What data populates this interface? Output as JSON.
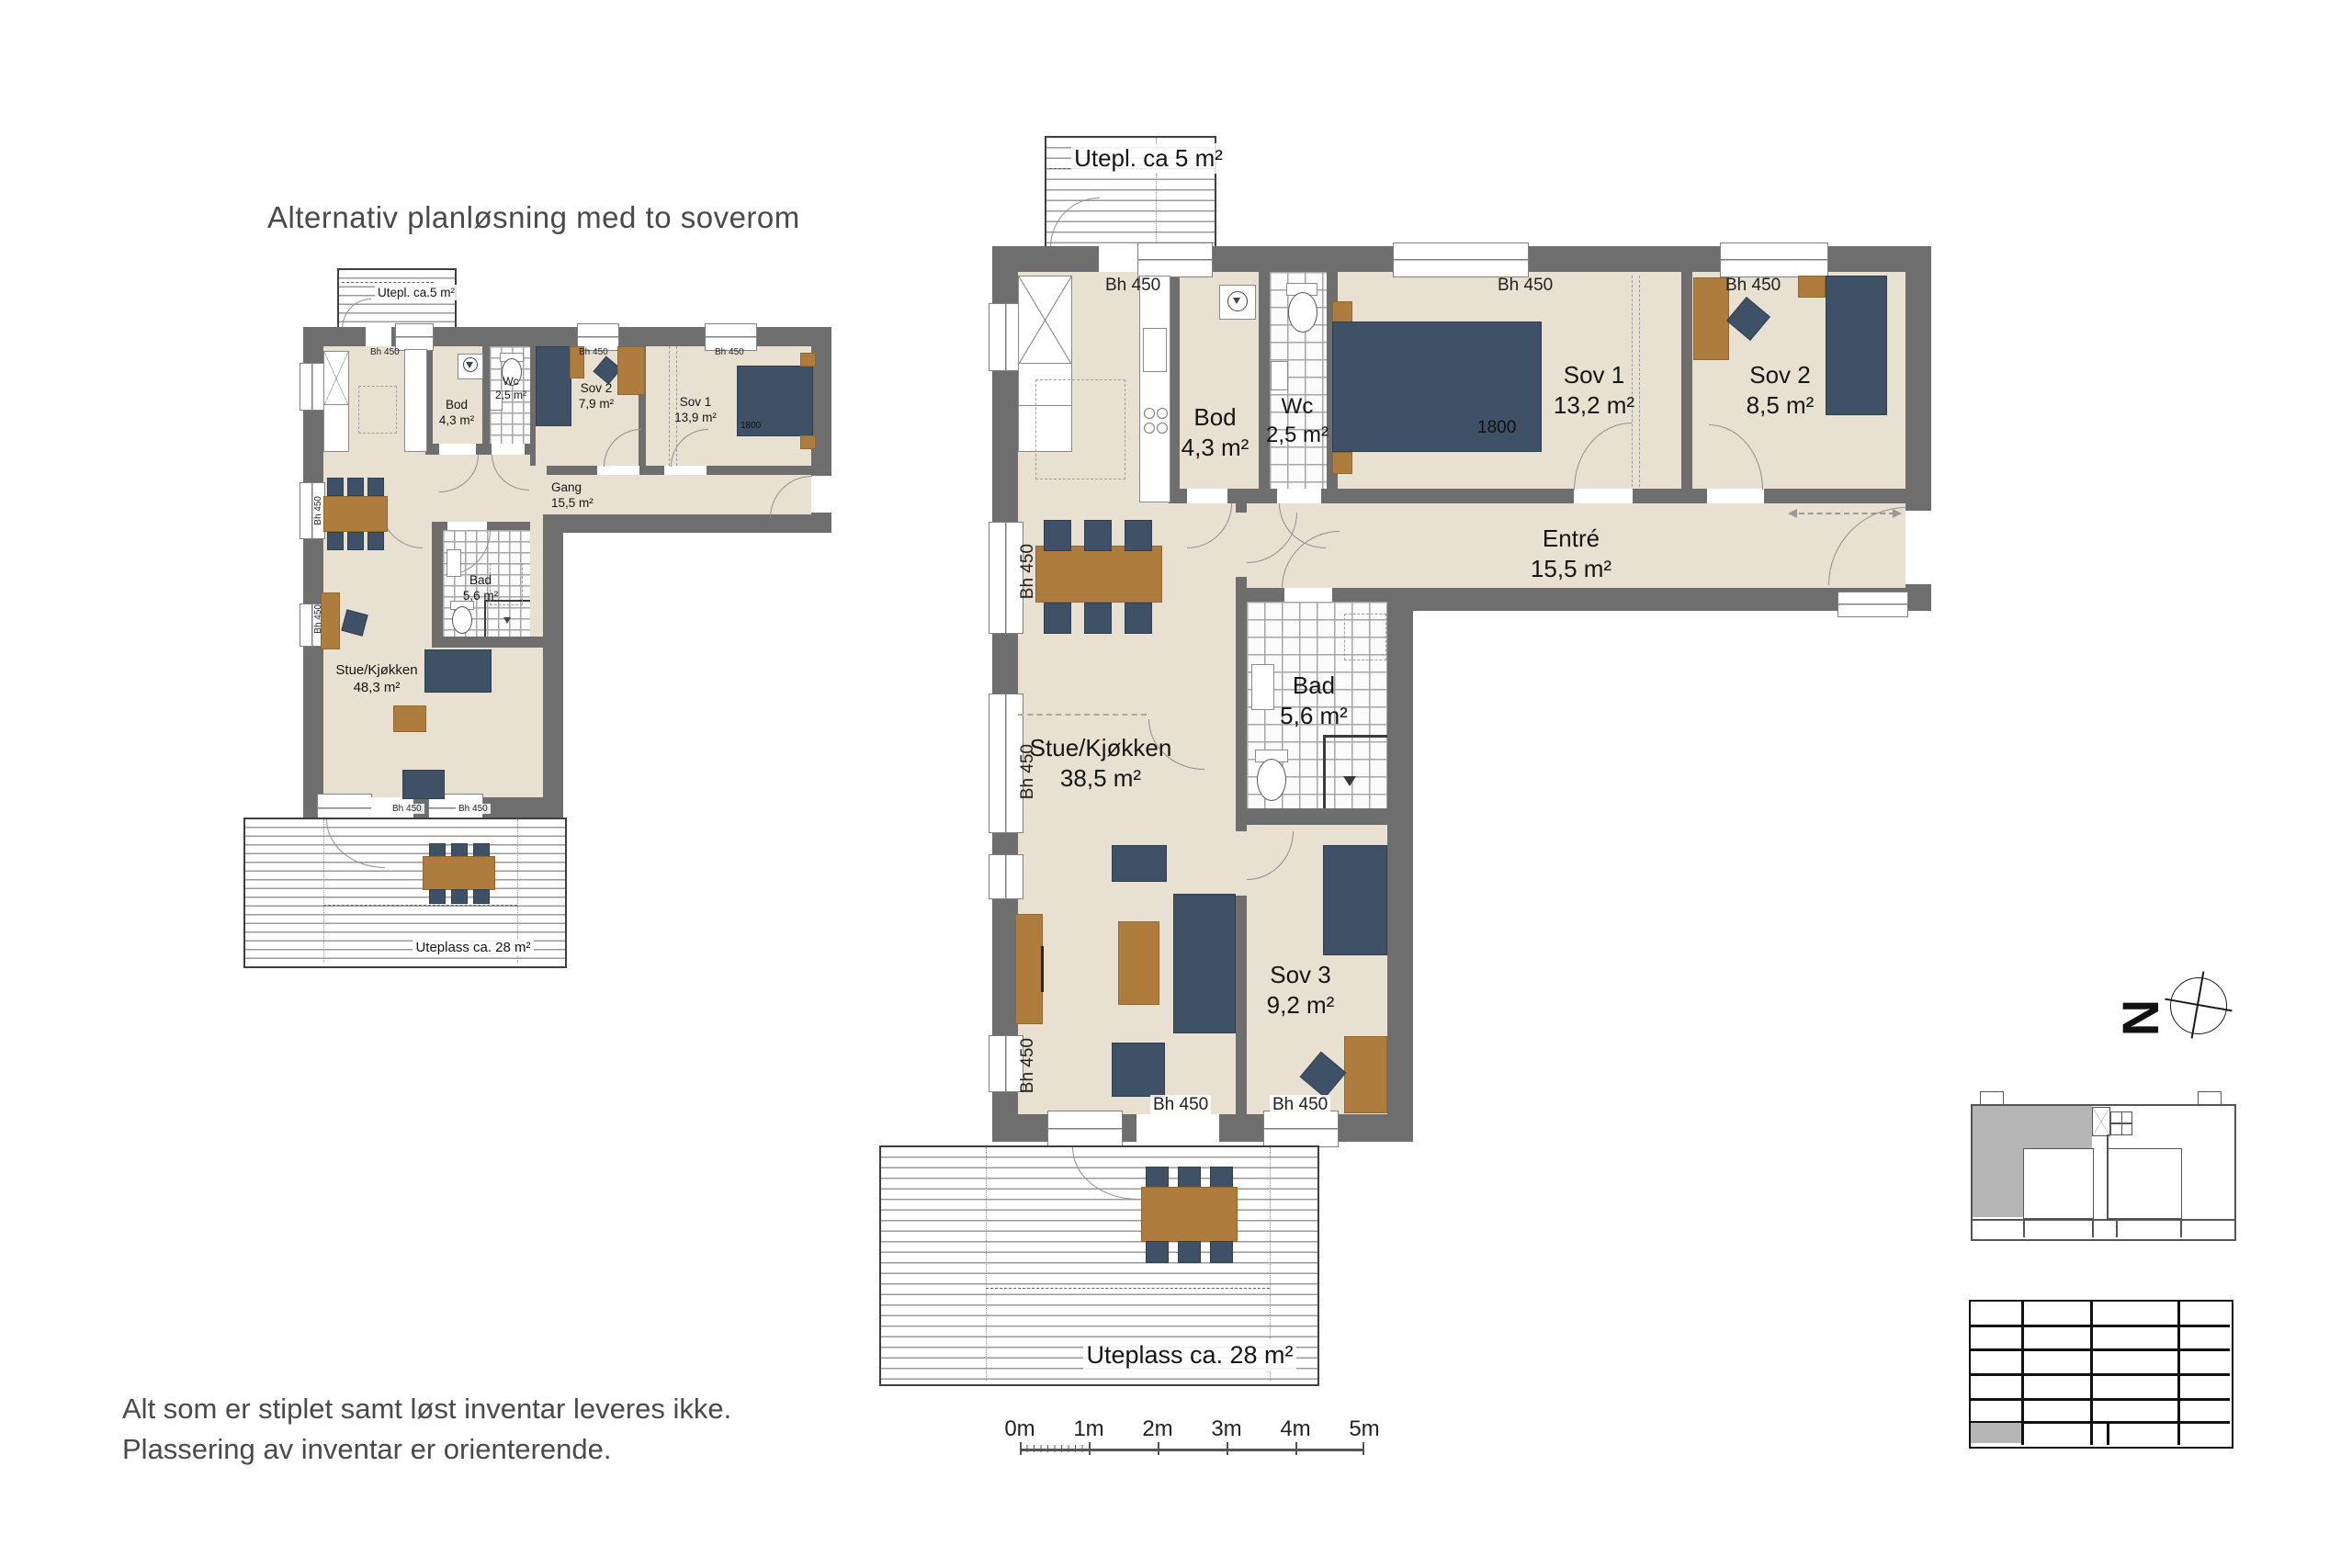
{
  "title": "Alternativ planløsning med to soverom",
  "labels": {
    "bh450": "Bh 450",
    "bed_width": "1800",
    "north": "N"
  },
  "alt_plan": {
    "balcony": "Utepl. ca.5 m²",
    "terrace": "Uteplass ca. 28 m²",
    "rooms": {
      "bod": {
        "name": "Bod",
        "area": "4,3 m²"
      },
      "wc": {
        "name": "Wc",
        "area": "2,5 m²"
      },
      "sov2": {
        "name": "Sov 2",
        "area": "7,9 m²"
      },
      "sov1": {
        "name": "Sov 1",
        "area": "13,9 m²"
      },
      "gang": {
        "name": "Gang",
        "area": "15,5 m²"
      },
      "bad": {
        "name": "Bad",
        "area": "5,6 m²"
      },
      "stue": {
        "name": "Stue/Kjøkken",
        "area": "48,3 m²"
      }
    }
  },
  "main_plan": {
    "balcony": "Utepl. ca 5 m²",
    "terrace": "Uteplass ca. 28 m²",
    "rooms": {
      "bod": {
        "name": "Bod",
        "area": "4,3 m²"
      },
      "wc": {
        "name": "Wc",
        "area": "2,5 m²"
      },
      "sov1": {
        "name": "Sov 1",
        "area": "13,2 m²"
      },
      "sov2": {
        "name": "Sov 2",
        "area": "8,5 m²"
      },
      "entre": {
        "name": "Entré",
        "area": "15,5 m²"
      },
      "bad": {
        "name": "Bad",
        "area": "5,6 m²"
      },
      "stue": {
        "name": "Stue/Kjøkken",
        "area": "38,5 m²"
      },
      "sov3": {
        "name": "Sov 3",
        "area": "9,2 m²"
      }
    }
  },
  "scale_bar": {
    "labels": [
      "0m",
      "1m",
      "2m",
      "3m",
      "4m",
      "5m"
    ]
  },
  "disclaimer": {
    "line1": "Alt som er stiplet samt løst inventar leveres ikke.",
    "line2": "Plassering av inventar er orienterende."
  },
  "colors": {
    "wall": "#6e6e6e",
    "floor": "#e8e0d1",
    "furniture_blue": "#3e5166",
    "furniture_wood": "#ae7d3e",
    "keyplan_highlight": "#b5b5b5"
  }
}
